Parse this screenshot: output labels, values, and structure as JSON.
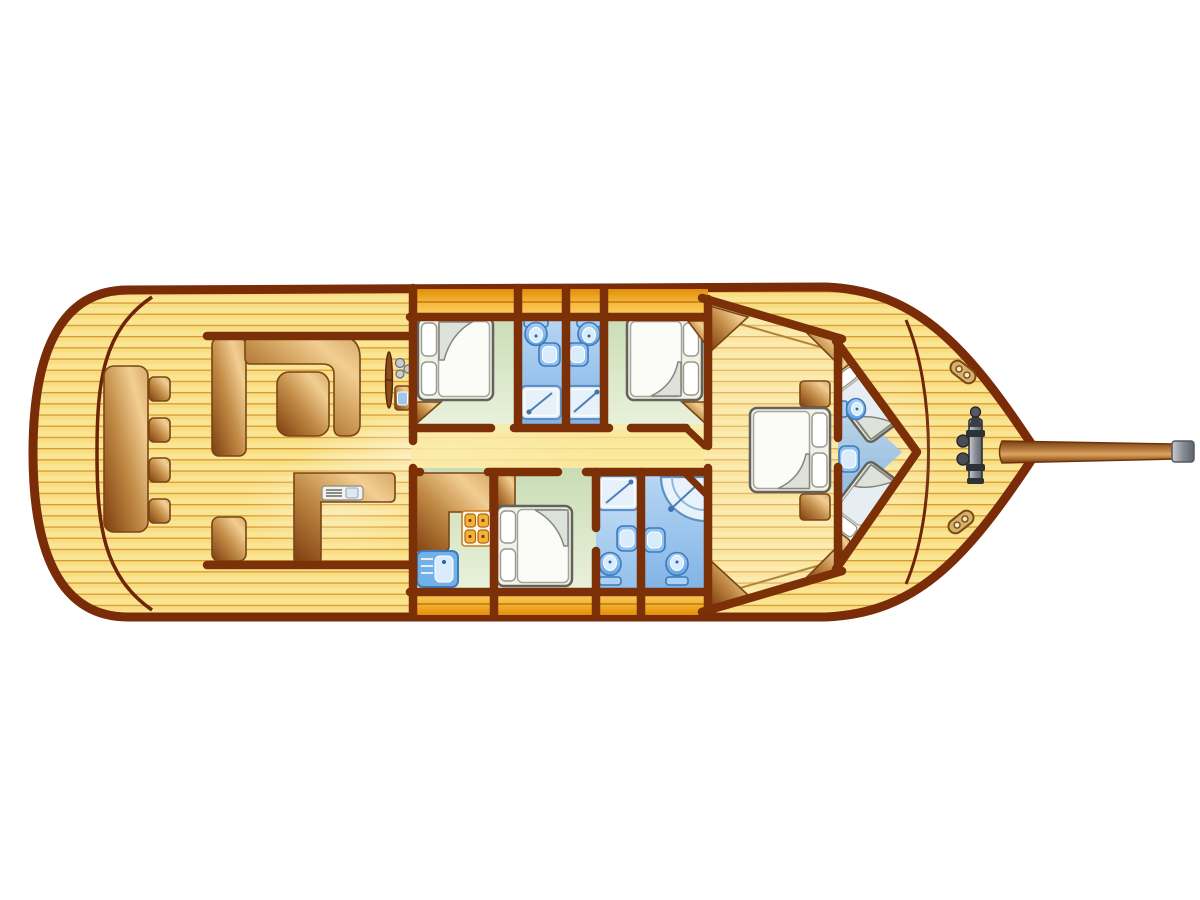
{
  "meta": {
    "aria_label": "Motor yacht interior deck plan, bow facing right",
    "canvas": {
      "width": 1200,
      "height": 900
    }
  },
  "palette": {
    "background": "#FFFFFF",
    "hull_outline": "#7A2B08",
    "wall": "#7C3008",
    "deck_plank": "#F9DD82",
    "plank_line": "#D79B2E",
    "side_band_orange": "#F2A71B",
    "cabin_floor_green": "#D8E7C6",
    "bathroom_floor_blue": "#9DC6EE",
    "fixture_blue": "#5FA3E4",
    "furniture_wood": "#C8904C",
    "bed_linen": "#F6F6EE",
    "metal_grey": "#8A9098"
  },
  "rooms": {
    "aft_deck": {
      "label": "Aft deck cockpit with dining table and four stools"
    },
    "salon": {
      "label": "Salon with corner settee, coffee table, cabinet and navigation counter"
    },
    "helm": {
      "label": "Helm station with steering wheel, instruments and console"
    },
    "corridor": {
      "label": "Central corridor"
    },
    "cabin_fwd_port": {
      "label": "Port double guest cabin"
    },
    "cabin_fwd_stbd": {
      "label": "Starboard double guest cabin"
    },
    "bathroom_port": {
      "label": "Port en-suite bathroom with toilet, basin and shower"
    },
    "bathroom_stbd": {
      "label": "Starboard en-suite bathroom with toilet, basin and shower"
    },
    "galley": {
      "label": "Galley with L-counter, four-burner stove and sink"
    },
    "cabin_mid": {
      "label": "Midship double cabin with wardrobe"
    },
    "bathroom_mid": {
      "label": "Bathroom with shower tray, basin and toilet"
    },
    "bathroom_corner": {
      "label": "Bathroom with corner shower, basin and toilet"
    },
    "master_cabin": {
      "label": "Master cabin with centered double bed, nightstands and corner wardrobes"
    },
    "v_berth": {
      "label": "Forepeak V-berth cabin with two angled berths, toilet and basin"
    },
    "foredeck": {
      "label": "Foredeck with anchor windlass, two cleats and bowsprit"
    }
  },
  "hardware": {
    "windlass": "anchor-windlass",
    "cleat_count": 2,
    "bowsprit": "wooden bowsprit pole with metal end cap"
  },
  "inventory": {
    "double_beds": 4,
    "single_berths": 2,
    "toilets": 5,
    "washbasins": 5,
    "showers": 4,
    "stools": 4,
    "stove_burners": 4
  }
}
